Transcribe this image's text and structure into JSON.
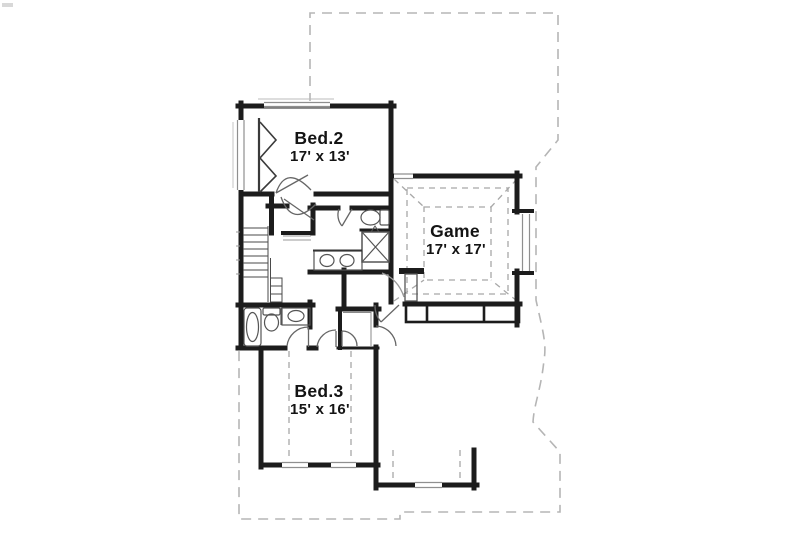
{
  "plan": {
    "type": "floor-plan",
    "background": "#ffffff",
    "colors": {
      "wall": "#1c1c1c",
      "fixture_line": "#555555",
      "window_line": "#8f8f8f",
      "lower_floor_dashed": "#b5b5b5",
      "ceiling_dashed": "#a8a8a8",
      "text": "#141414"
    },
    "rooms": [
      {
        "id": "bed2",
        "name": "Bed.2",
        "dimensions": "17' x 13'"
      },
      {
        "id": "game",
        "name": "Game",
        "dimensions": "17' x 17'"
      },
      {
        "id": "bed3",
        "name": "Bed.3",
        "dimensions": "15' x 16'"
      }
    ],
    "fixture_icons": [
      "stairs-icon",
      "bathtub-icon",
      "toilet-icon",
      "shower-icon",
      "double-sink-vanity-icon",
      "sink-vanity-icon",
      "bifold-closet-door-icon",
      "door-swing-icon",
      "window-icon",
      "tray-ceiling-icon"
    ]
  }
}
